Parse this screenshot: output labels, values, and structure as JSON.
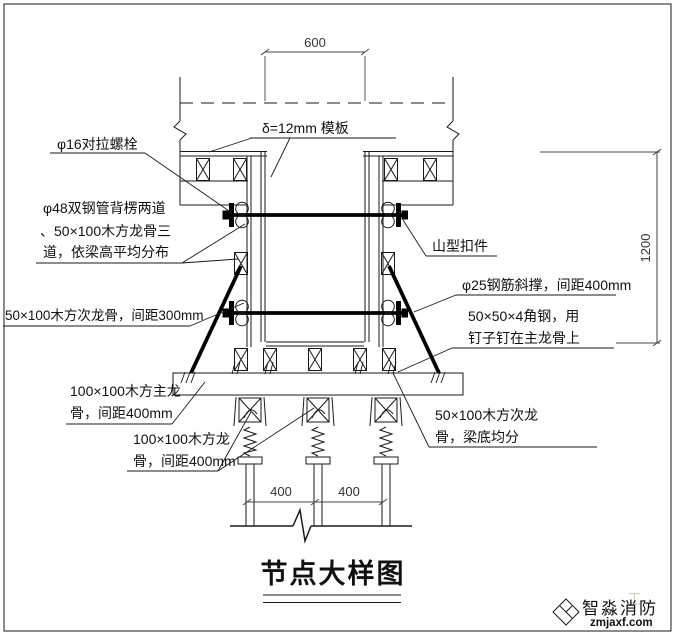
{
  "page": {
    "border_color": "#8c8c8c",
    "line_color": "#1a1a1a"
  },
  "dimensions": {
    "beam_width": "600",
    "beam_height": "1200",
    "post_spacing_left": "400",
    "post_spacing_right": "400"
  },
  "labels": {
    "formwork": "δ=12mm 模板",
    "tie_bolt": "φ16对拉螺栓",
    "wale_line1": "φ48双钢管背楞两道",
    "wale_line2": "、50×100木方龙骨三",
    "wale_line3": "道，依梁高平均分布",
    "secondary_joist": "50×100木方次龙骨，间距300mm",
    "main_joist_line1": "100×100木方主龙",
    "main_joist_line2": "骨，间距400mm",
    "bottom_joist_line1": "100×100木方龙",
    "bottom_joist_line2": "骨，间距400mm",
    "clamp": "山型扣件",
    "diagonal_brace": "φ25钢筋斜撑，间距400mm",
    "angle_steel_line1": "50×50×4角钢，用",
    "angle_steel_line2": "钉子钉在主龙骨上",
    "beam_bottom_joist_line1": "50×100木方次龙",
    "beam_bottom_joist_line2": "骨，梁底均分"
  },
  "title": {
    "text": "节点大样图"
  },
  "logo": {
    "name": "智淼消防",
    "domain": "zmjaxf.com",
    "watermark": "工",
    "icon_color": "#8a6e5e",
    "name_color": "#8a8070",
    "domain_color": "#3e3a33"
  }
}
